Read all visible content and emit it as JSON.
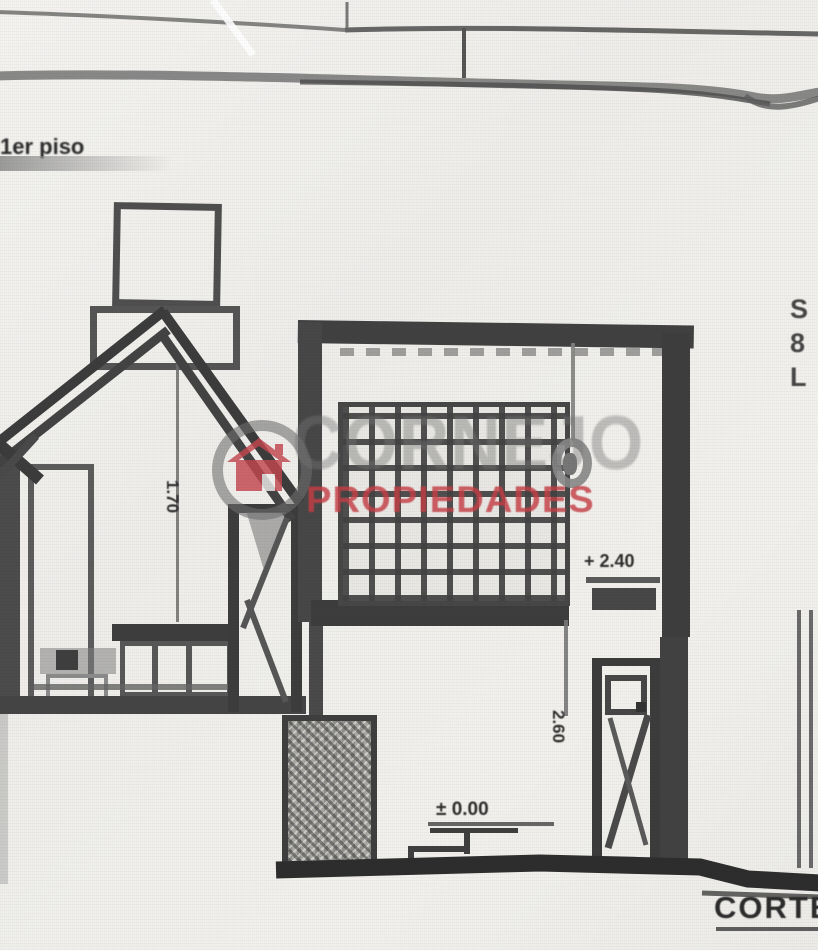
{
  "colors": {
    "paper": "#f1f0ed",
    "ink": "#3b3b3b",
    "watermark_red": "#c8505a",
    "watermark_gray": "#8c8c8c"
  },
  "titles": {
    "top_left": "1er piso",
    "bottom_right": "CORTE"
  },
  "watermark": {
    "brand": "CORNEJO",
    "subtitle": "PROPIEDADES"
  },
  "annotations": {
    "roof_height_dim": "1.70",
    "upper_level": "+ 2.40",
    "ground_level": "± 0.00",
    "door_height_dim": "2.60",
    "edge_labels": [
      "S",
      "8",
      "L"
    ]
  }
}
